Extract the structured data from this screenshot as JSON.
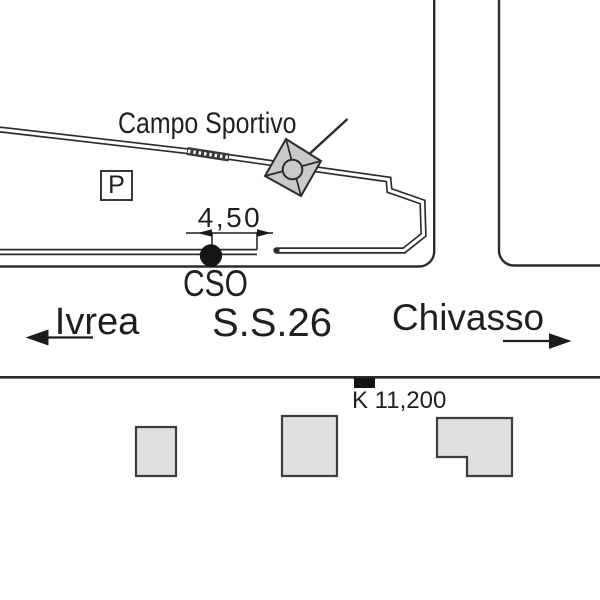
{
  "diagram": {
    "sports_field_label": "Campo Sportivo",
    "parking_label": "P",
    "dimension_label": "4,50",
    "sign_label": "CSO",
    "left_destination": "Ivrea",
    "road_label": "S.S.26",
    "right_destination": "Chivasso",
    "km_marker_label": "K 11,200",
    "colors": {
      "line": "#2b2b2b",
      "text": "#1f1f1f",
      "building_fill": "#dfdfdf",
      "building_stroke": "#3d3d3d",
      "symbol_fill": "#c9c9c9",
      "marker_fill": "#141414",
      "background": "#ffffff"
    }
  }
}
